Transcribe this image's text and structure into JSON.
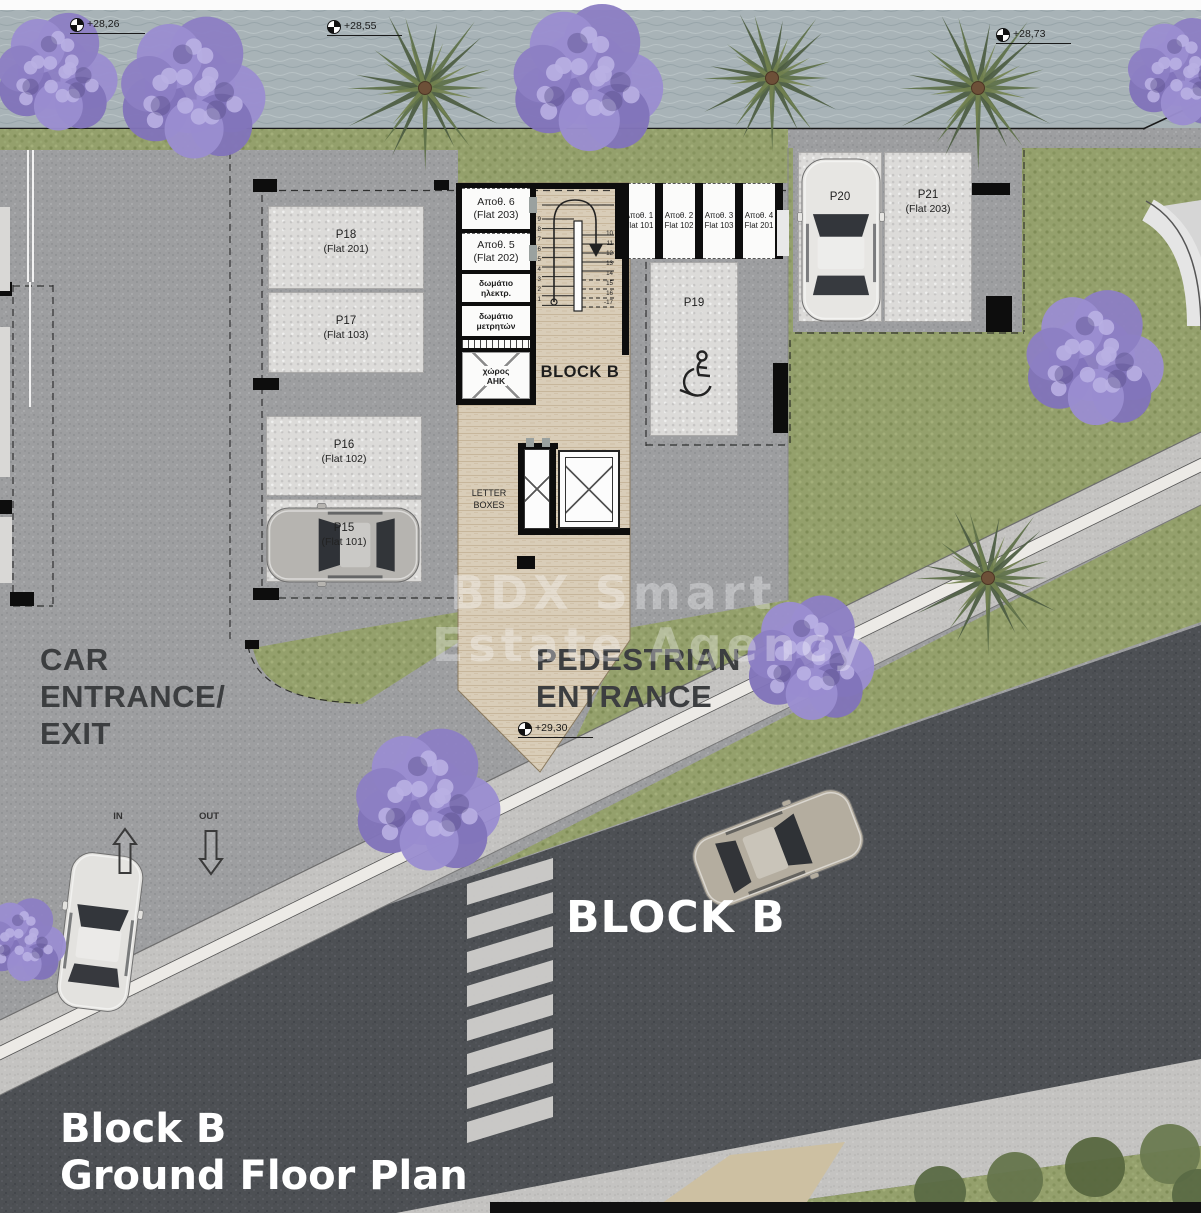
{
  "title": {
    "line1": "Block B",
    "line2": "Ground Floor Plan"
  },
  "road_label": "BLOCK B",
  "watermark": {
    "line1": "BDX Smart",
    "line2": "Estate Agency"
  },
  "markers": {
    "m1": "+28,26",
    "m2": "+28,55",
    "m3": "+28,73",
    "m4": "+29,30"
  },
  "entrance": {
    "car1": "CAR",
    "car2": "ENTRANCE/",
    "car3": "EXIT",
    "ped1": "PEDESTRIAN",
    "ped2": "ENTRANCE",
    "in": "IN",
    "out": "OUT"
  },
  "building": {
    "label": "BLOCK B",
    "letter1": "LETTER",
    "letter2": "BOXES",
    "storage_left": [
      {
        "name": "Αποθ. 6",
        "flat": "(Flat 203)"
      },
      {
        "name": "Αποθ. 5",
        "flat": "(Flat 202)"
      }
    ],
    "rooms": [
      {
        "l1": "δωμάτιο",
        "l2": "ηλεκτρ."
      },
      {
        "l1": "δωμάτιο",
        "l2": "μετρητών"
      },
      {
        "l1": "χώρος",
        "l2": "ΑΗΚ"
      }
    ],
    "storage_right": [
      {
        "name": "Αποθ. 1",
        "flat": "Flat 101"
      },
      {
        "name": "Αποθ. 2",
        "flat": "Flat 102"
      },
      {
        "name": "Αποθ. 3",
        "flat": "Flat 103"
      },
      {
        "name": "Αποθ. 4",
        "flat": "Flat 201"
      }
    ],
    "stairs_left": [
      "9",
      "8",
      "7",
      "6",
      "5",
      "4",
      "3",
      "2",
      "1"
    ],
    "stairs_right": [
      "10",
      "11",
      "12",
      "13",
      "14",
      "15",
      "16",
      "-17"
    ]
  },
  "parking": {
    "p18": {
      "id": "P18",
      "flat": "(Flat 201)"
    },
    "p17": {
      "id": "P17",
      "flat": "(Flat 103)"
    },
    "p16": {
      "id": "P16",
      "flat": "(Flat 102)"
    },
    "p15": {
      "id": "P15",
      "flat": "(Flat 101)"
    },
    "p19": {
      "id": "P19"
    },
    "p20": {
      "id": "P20"
    },
    "p21": {
      "id": "P21",
      "flat": "(Flat 203)"
    }
  },
  "colors": {
    "road": "#4d5054",
    "lawn": "#94a06c",
    "asphalt": "#9d9ea0",
    "travertine": "#d9cdb8",
    "jacaranda": "#8c7fc4",
    "palm": "#4c5d42"
  }
}
